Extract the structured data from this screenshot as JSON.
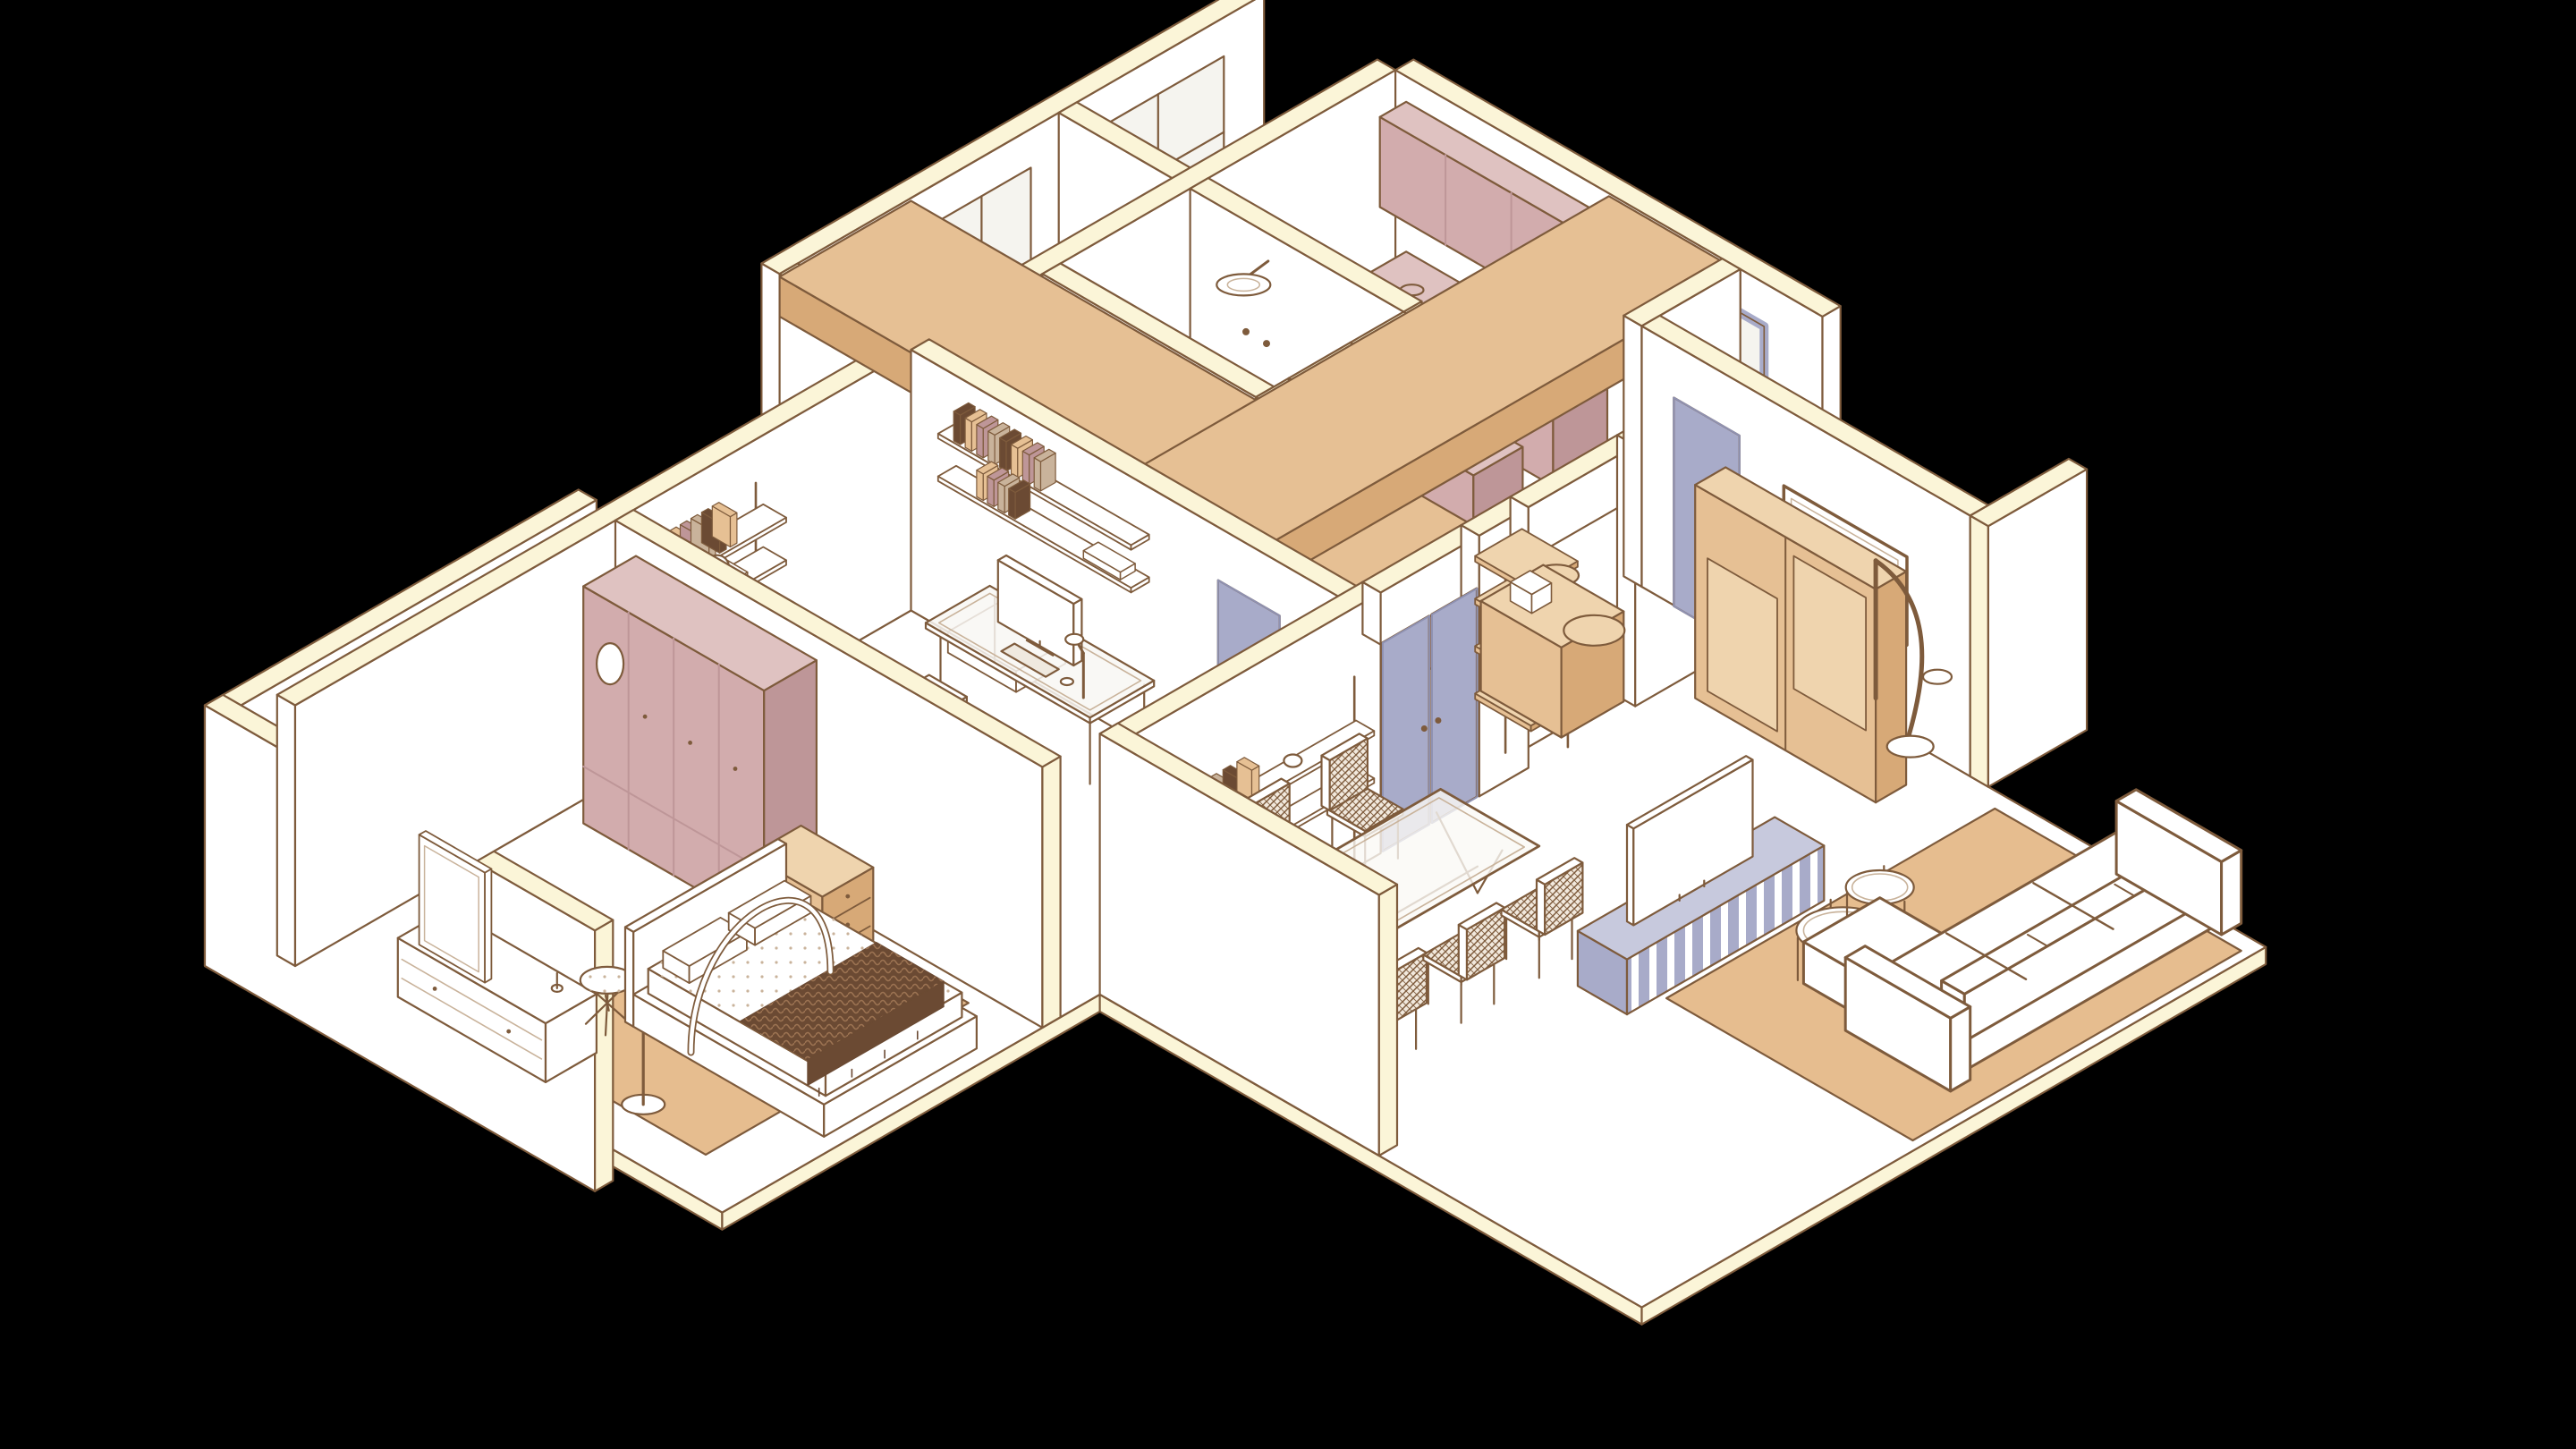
{
  "meta": {
    "kind": "isometric-apartment-cutaway-illustration",
    "background": "#000000",
    "projection": "isometric-30deg",
    "visible_text": ""
  },
  "palette": {
    "background": "#000000",
    "outline": "#7E5B3C",
    "lineFaint": "#C9B39B",
    "tile": "#C4AE93",
    "cream": "#FBF5D8",
    "white": "#FFFFFF",
    "glass": "#F5F4EF",
    "mauve": "#D2ACAD",
    "mauveDark": "#BE9698",
    "mauveLight": "#DFC2C1",
    "tan": "#E6C094",
    "tanDark": "#D7A977",
    "tanLight": "#EFD4AE",
    "rug": "#E6BD8F",
    "lavender": "#A8ABC9",
    "lavenderDark": "#8F92B2",
    "lavenderLight": "#C7C9DD",
    "darkBrown": "#6B4A33",
    "knit": "#9C7352",
    "weaveBase": "#F1E8DC"
  },
  "rooms": [
    {
      "id": "master-bedroom",
      "label": "Master bedroom",
      "furniture": [
        "mauve-wardrobe",
        "chest-of-drawers",
        "dresser-with-mirror",
        "floor-lamp",
        "bedside-stool",
        "double-bed",
        "dark-knit-throw",
        "area-rug",
        "bed-canopy-arc"
      ]
    },
    {
      "id": "home-office",
      "label": "Home office",
      "furniture": [
        "glass-desk",
        "monitor",
        "keyboard",
        "desk-lamp",
        "woven-office-chair",
        "wall-shelves-with-books",
        "lavender-door"
      ]
    },
    {
      "id": "balcony-laundry",
      "label": "Balcony / laundry",
      "furniture": [
        "tiled-walls",
        "radiator",
        "drying-rack",
        "lavender-sliding-door"
      ]
    },
    {
      "id": "bathroom",
      "label": "Bathroom",
      "furniture": [
        "rain-shower",
        "glass-partition",
        "toiletry-bottles",
        "lavender-door"
      ]
    },
    {
      "id": "hallway",
      "label": "Hallway",
      "furniture": [
        "tan-ceiling-soffits",
        "lavender-double-doors"
      ]
    },
    {
      "id": "kitchen",
      "label": "Kitchen",
      "furniture": [
        "mauve-upper-cabinets",
        "mauve-base-cabinets",
        "cooktop-burners",
        "utensil-rail",
        "lavender-framed-window",
        "tall-coffee-cabinet",
        "coffee-machine",
        "tan-bar-counter",
        "round-shelf-tower"
      ]
    },
    {
      "id": "dining-room",
      "label": "Dining room",
      "furniture": [
        "glass-dining-table",
        "six-woven-chairs",
        "wall-bookshelf"
      ]
    },
    {
      "id": "living-room",
      "label": "Living room",
      "furniture": [
        "white-sectional-sofa",
        "striped-lavender-media-console",
        "tv-on-console",
        "nesting-round-coffee-tables",
        "tan-area-rug",
        "tan-sliding-shelf",
        "arc-floor-lamp",
        "wall-mounted-tv"
      ]
    },
    {
      "id": "storage-room",
      "label": "Storage room",
      "furniture": [
        "lavender-door"
      ]
    },
    {
      "id": "back-rooms",
      "label": "Back rooms",
      "furniture": [
        "windows"
      ]
    }
  ]
}
